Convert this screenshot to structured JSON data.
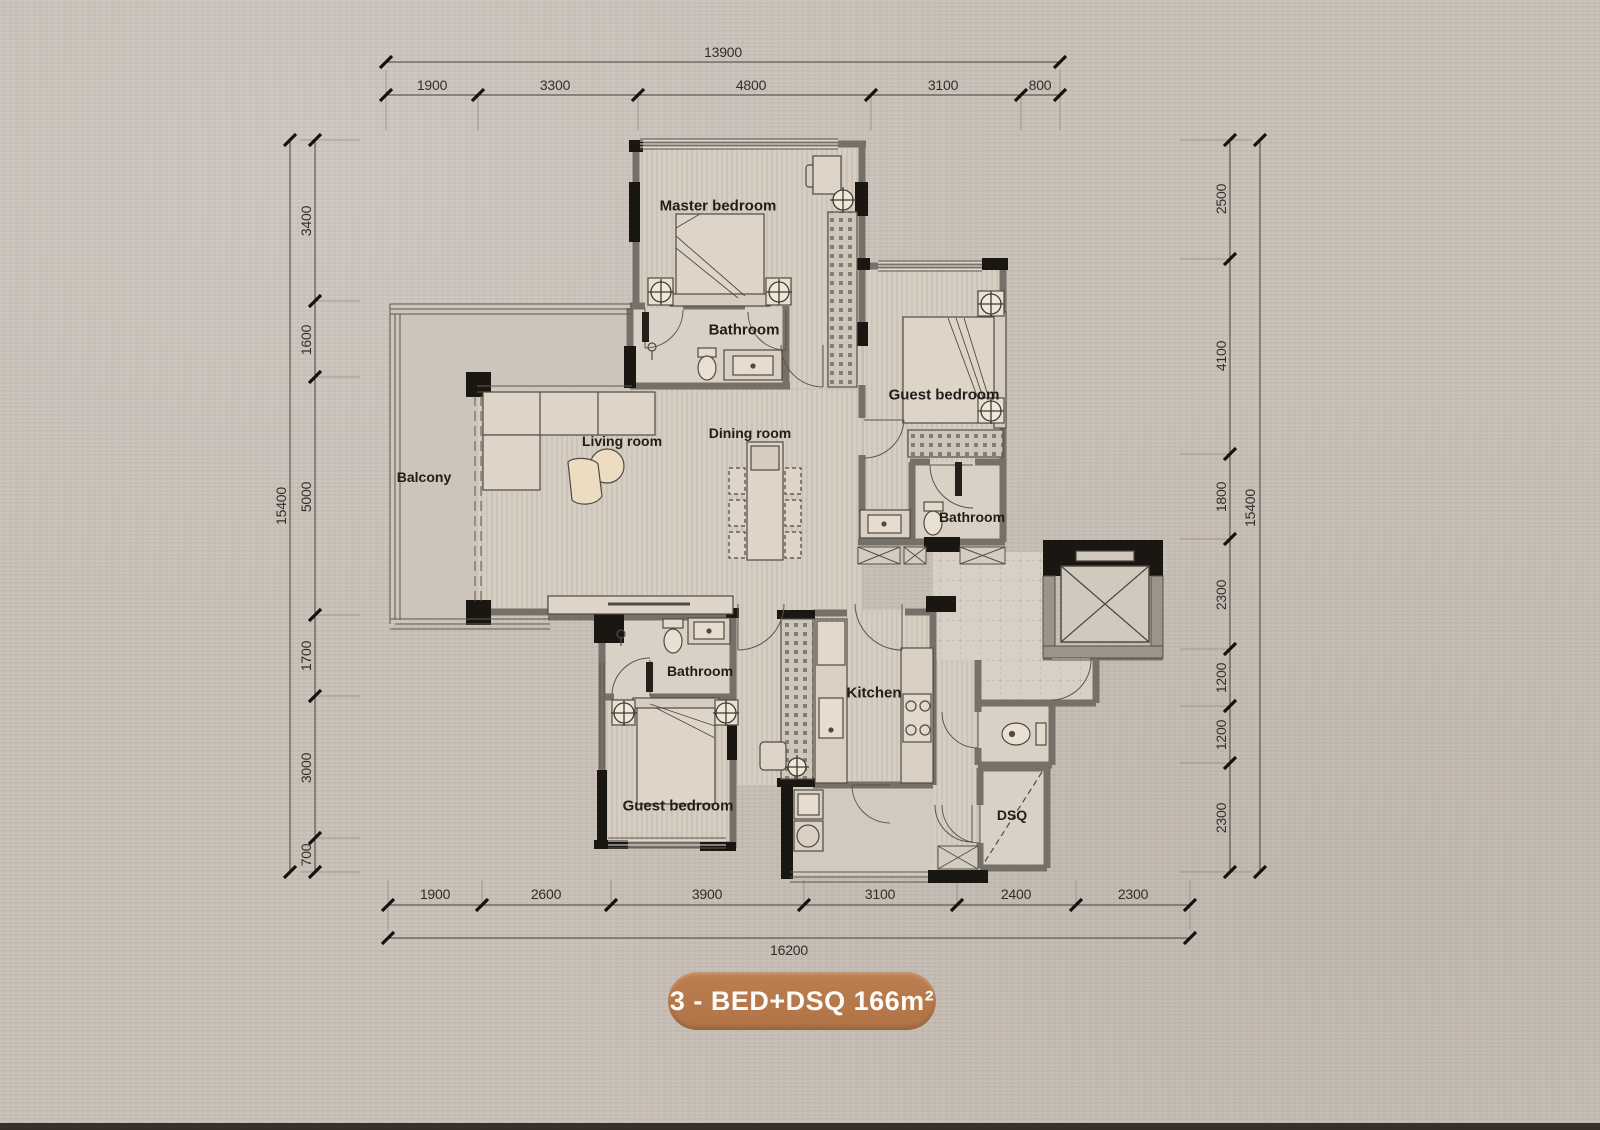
{
  "plan": {
    "title_badge": "3 - BED+DSQ  166m²",
    "rooms": [
      {
        "id": "master-bedroom",
        "label": "Master bedroom"
      },
      {
        "id": "master-bathroom",
        "label": "Bathroom"
      },
      {
        "id": "guest-bedroom-top",
        "label": "Guest bedroom"
      },
      {
        "id": "guest-bathroom",
        "label": "Bathroom"
      },
      {
        "id": "living-room",
        "label": "Living room"
      },
      {
        "id": "dining-room",
        "label": "Dining room"
      },
      {
        "id": "balcony",
        "label": "Balcony"
      },
      {
        "id": "bottom-bathroom",
        "label": "Bathroom"
      },
      {
        "id": "guest-bedroom-bottom",
        "label": "Guest bedroom"
      },
      {
        "id": "kitchen",
        "label": "Kitchen"
      },
      {
        "id": "dsq",
        "label": "DSQ"
      }
    ],
    "dimensions": {
      "top": {
        "total": "13900",
        "segments": [
          "1900",
          "3300",
          "4800",
          "3100",
          "800"
        ]
      },
      "left": {
        "total": "15400",
        "segments": [
          "3400",
          "1600",
          "5000",
          "1700",
          "3000",
          "700"
        ]
      },
      "right": {
        "total": "15400",
        "segments": [
          "2500",
          "4100",
          "1800",
          "2300",
          "1200",
          "1200",
          "2300"
        ]
      },
      "bottom": {
        "total": "16200",
        "segments": [
          "1900",
          "2600",
          "3900",
          "3100",
          "2400",
          "2300"
        ]
      }
    },
    "colors": {
      "badge": "#b5794b",
      "paper": "#cac1b8",
      "floor": "#d7cec3",
      "wall_gray": "#757068",
      "wall_black": "#1a1712"
    }
  }
}
